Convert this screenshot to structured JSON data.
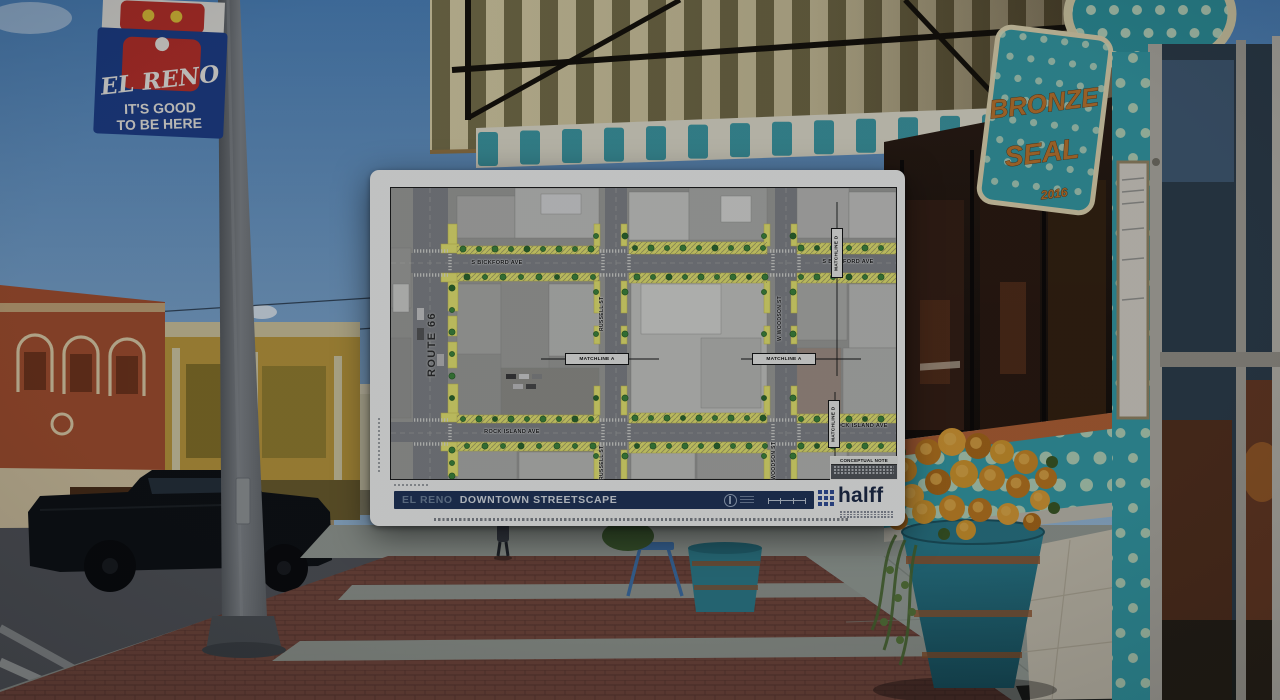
{
  "photo": {
    "banner": {
      "title": "EL RENO",
      "tagline_line1": "IT'S GOOD",
      "tagline_line2": "TO BE HERE"
    },
    "storefront_sign": {
      "word1": "BRONZE",
      "word2": "SEAL",
      "year": "2016"
    }
  },
  "plan": {
    "titlebar": {
      "city": "EL RENO",
      "project": "DOWNTOWN STREETSCAPE"
    },
    "firm": "halff",
    "labels": {
      "route_66": "ROUTE 66",
      "s_bickford_w": "S BICKFORD AVE",
      "s_bickford_e": "S BICKFORD AVE",
      "rock_island_w": "ROCK ISLAND AVE",
      "rock_island_e": "ROCK ISLAND AVE",
      "russell_n": "RUSSELL ST",
      "russell_s": "RUSSELL ST",
      "woodson_n": "W WOODSON ST",
      "woodson_s": "WOODSON ST",
      "matchline_a_w": "MATCHLINE A",
      "matchline_a_e": "MATCHLINE A",
      "matchline_d_n": "MATCHLINE D",
      "matchline_d_s": "MATCHLINE D",
      "conceptual_note": "CONCEPTUAL NOTE"
    },
    "colors": {
      "titlebar_navy": "#20345a",
      "streetscape_yellow": "#f0ee74",
      "tree_green": "#3f8a3c",
      "halff_blue": "#33509b"
    }
  },
  "photo_colors": {
    "banner_blue": "#1d3f8c",
    "storefront_teal": "#35a0ab",
    "awning_olive": "#7c744c",
    "brick_sidewalk": "#77493d"
  }
}
